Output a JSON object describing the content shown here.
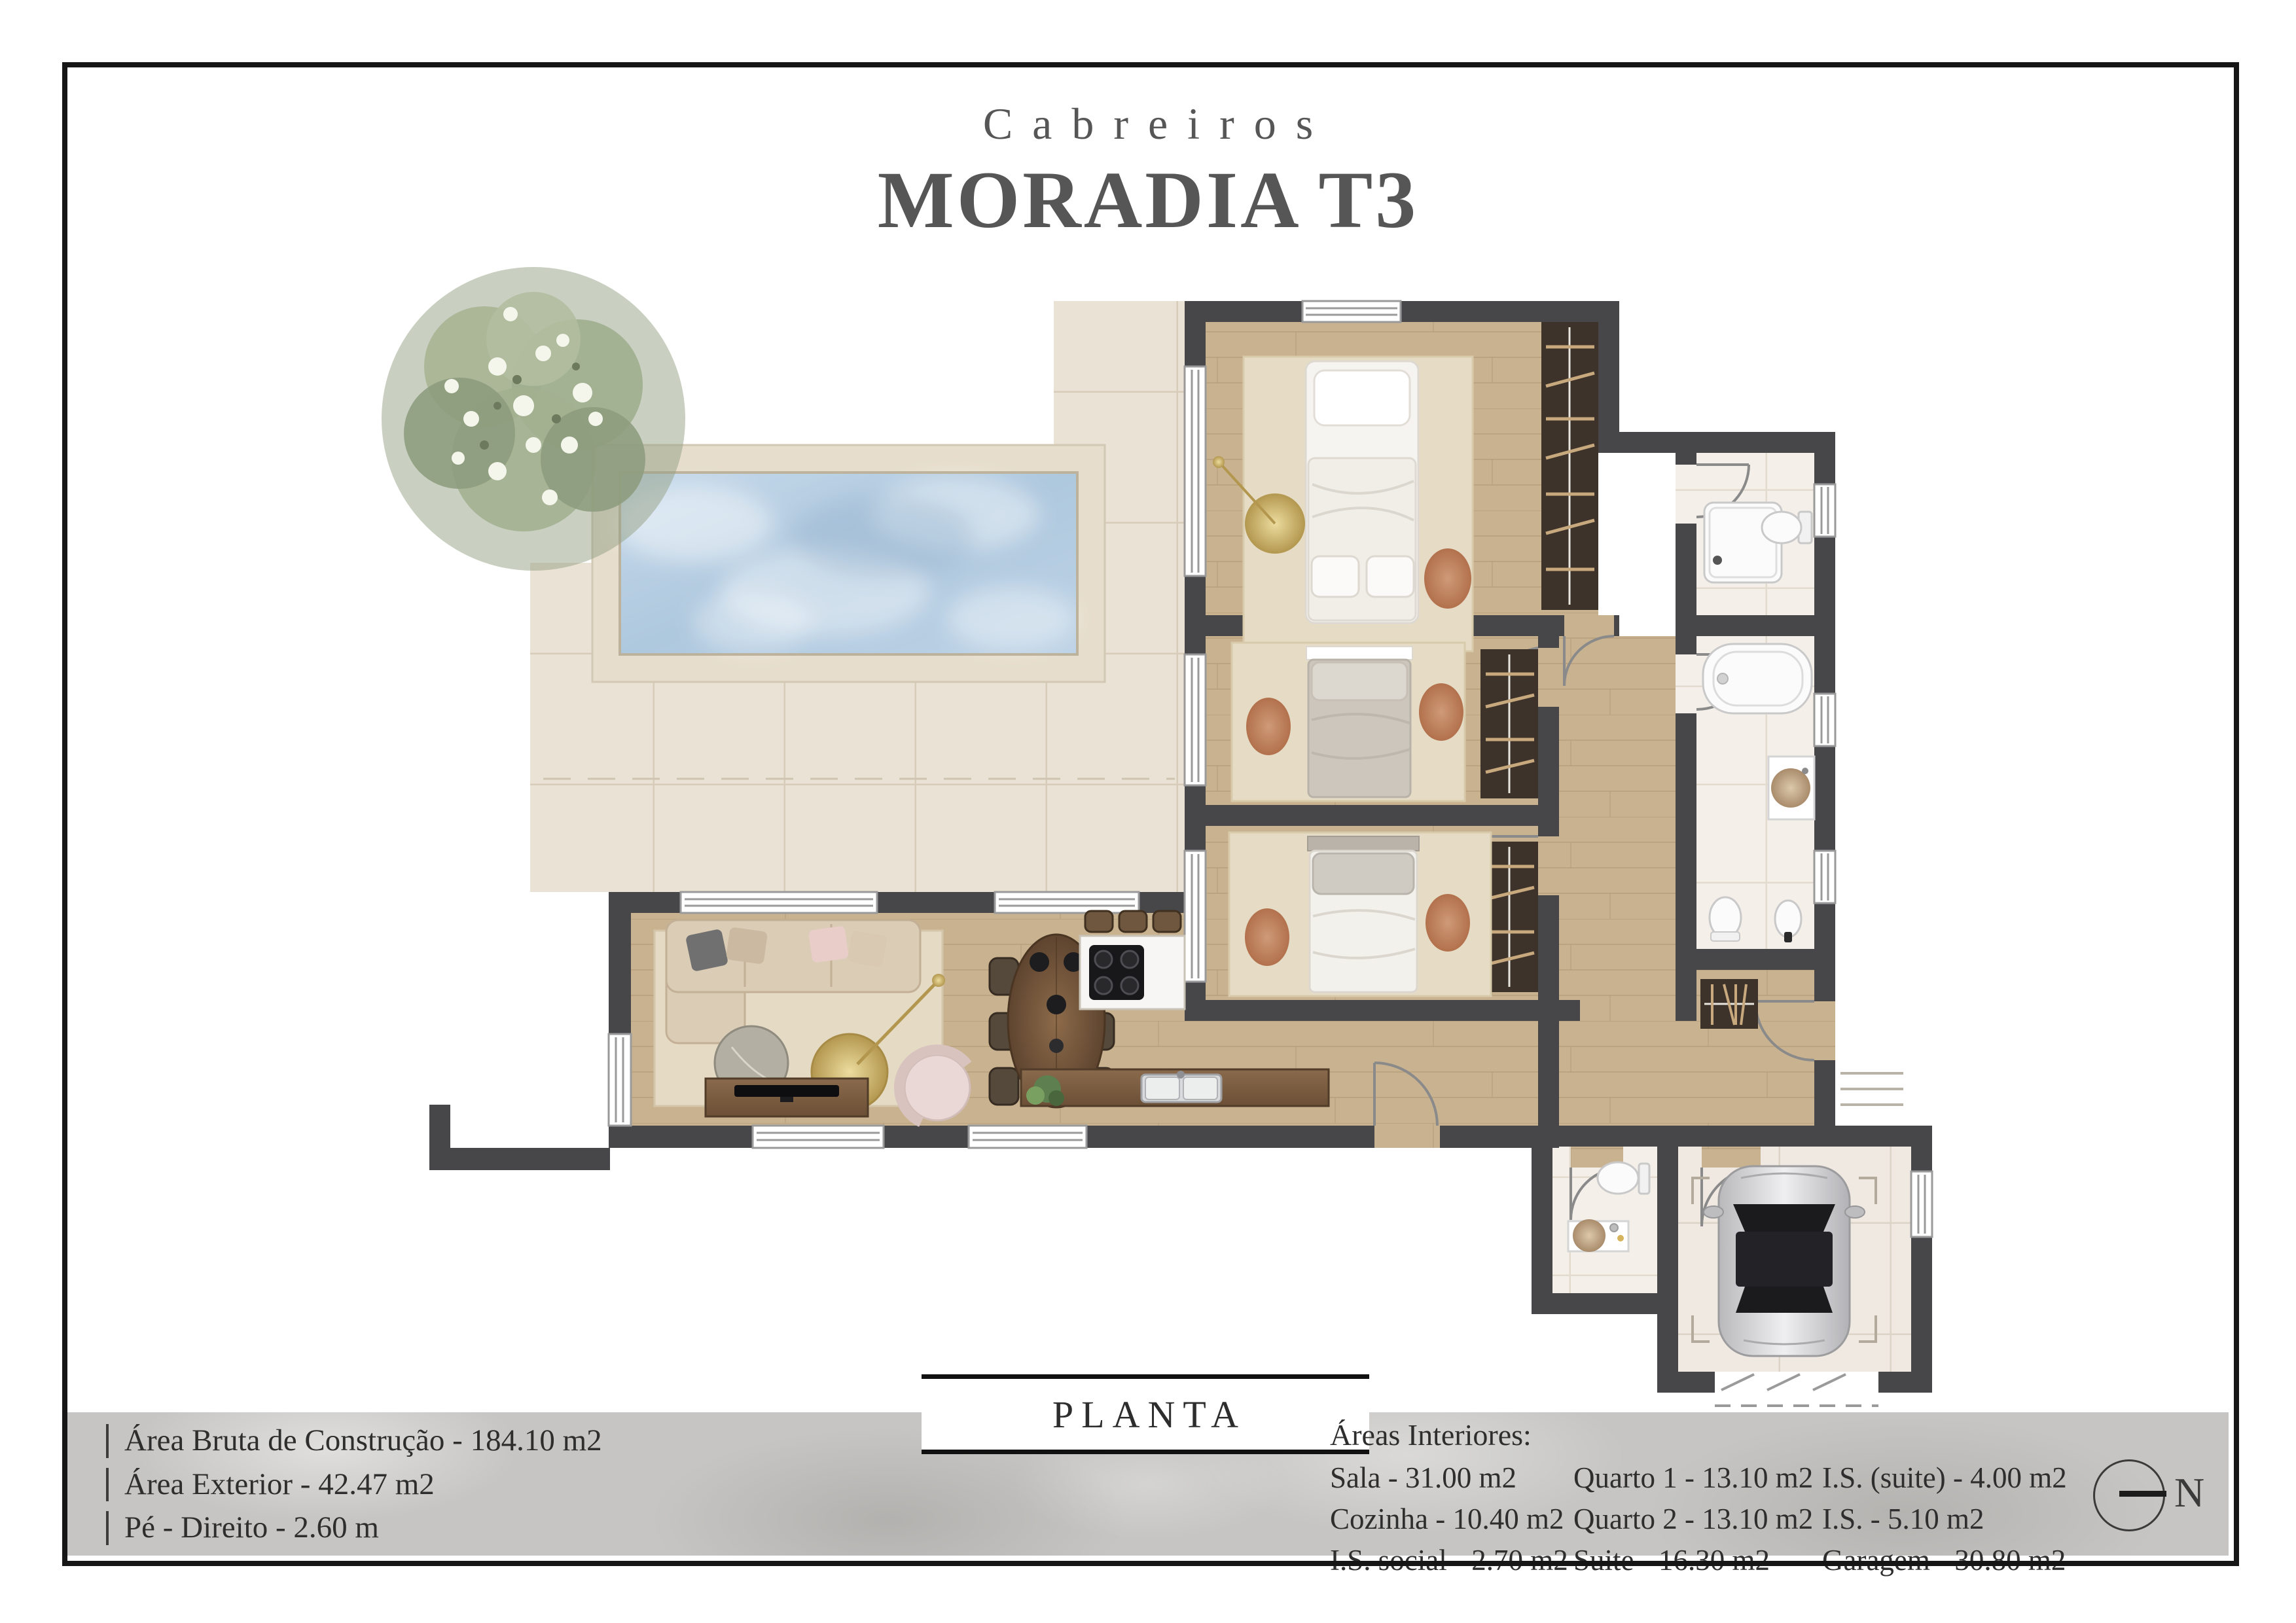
{
  "header": {
    "brand": "Cabreiros",
    "title": "MORADIA T3"
  },
  "plan_label": "PLANTA",
  "north_label": "N",
  "specs_left": [
    {
      "text": "Área Bruta de Construção - 184.10 m2"
    },
    {
      "text": "Área Exterior - 42.47 m2"
    },
    {
      "text": "Pé - Direito - 2.60 m"
    }
  ],
  "interior_areas": {
    "title": "Áreas Interiores:",
    "columns": [
      [
        "Sala - 31.00 m2",
        "Cozinha - 10.40 m2",
        "I.S. social - 2.70 m2"
      ],
      [
        "Quarto 1 - 13.10 m2",
        "Quarto 2 - 13.10 m2",
        "Suite - 16.30 m2"
      ],
      [
        "I.S. (suite) - 4.00 m2",
        "I.S. - 5.10 m2",
        "Garagem - 30.80 m2"
      ]
    ]
  },
  "palette": {
    "wall": "#47474a",
    "wood": "#c9b28f",
    "rug": "#e6dcc6",
    "terrace_tile": "#eae2d4",
    "bath_tile": "#f4efe9",
    "garage_tile": "#f0e9e1",
    "deck": "#e6ddcc",
    "pool_water": "#b5cde2",
    "wardrobe": "#3e332a",
    "hanger": "#c8a97e",
    "counter_wood": "#7c5e43",
    "sofa": "#dbccb6",
    "gold": "#cdb36a",
    "car_silver": "#d7d7d9",
    "band_gray": "#c6c5c3",
    "title_gray": "#565656"
  }
}
